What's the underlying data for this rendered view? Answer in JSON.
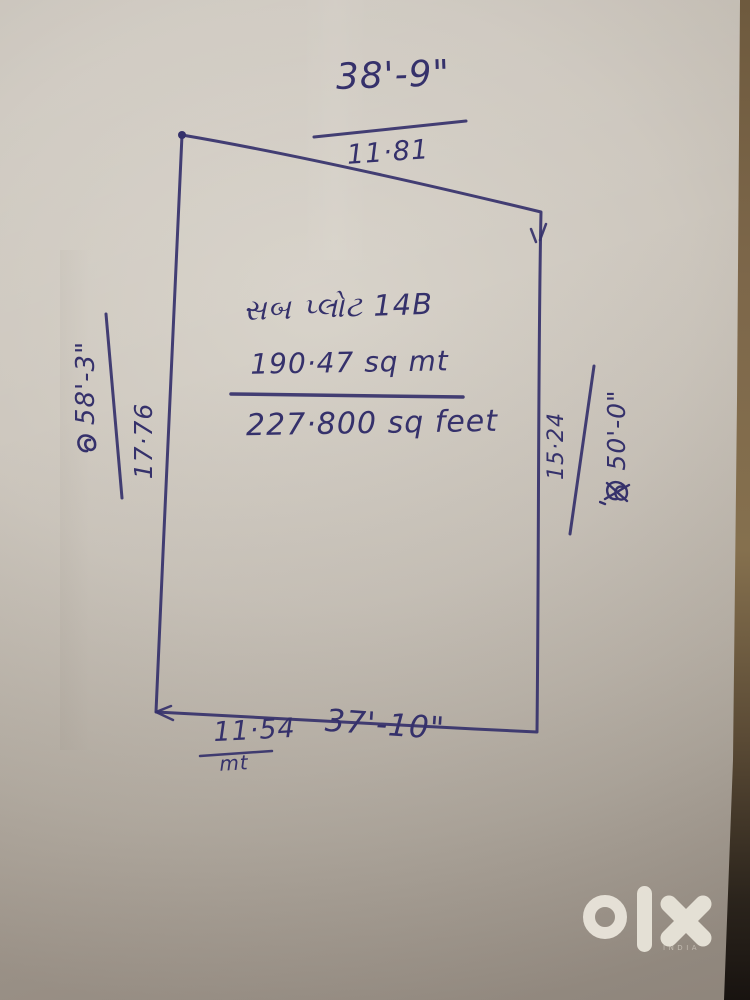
{
  "sketch": {
    "plot_label_gujarati": "સબ પ્લોટ 14B",
    "area_sq_mt": "190·47 sq mt",
    "area_sq_feet": "227·800 sq feet",
    "sides": {
      "top": {
        "feet_inches": "38'-9\"",
        "meters": "11·81"
      },
      "left": {
        "feet_inches": "58'-3\"",
        "meters": "17·76"
      },
      "right": {
        "meters": "15·24",
        "feet_inches": "50'-0\""
      },
      "bottom": {
        "meters": "11·54",
        "meters_unit": "mt",
        "feet_inches": "37'-10\""
      }
    }
  },
  "watermark": {
    "brand": "olx",
    "country": "INDIA"
  },
  "colors": {
    "ink": "#35316b",
    "paper_light": "#d8d3ca",
    "paper_dark": "#a79e94",
    "watermark": "#e9e5da"
  }
}
